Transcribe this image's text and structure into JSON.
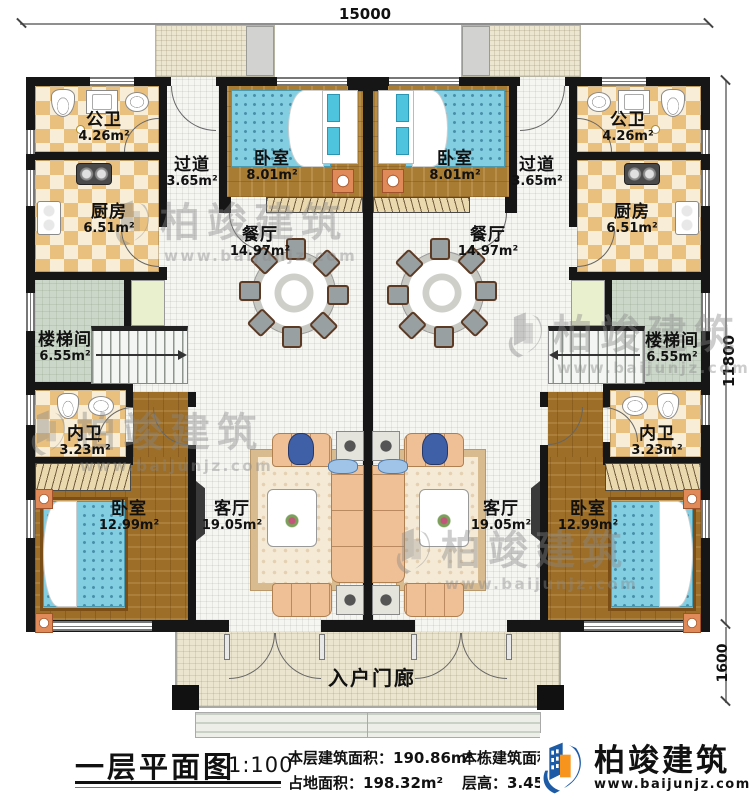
{
  "dimensions": {
    "top": "15000",
    "right_upper": "11800",
    "right_lower": "1600"
  },
  "watermark": {
    "brand": "柏竣建筑",
    "url": "www.baijunjz.com"
  },
  "units": {
    "left": {
      "rooms": [
        {
          "name": "公卫",
          "area": "4.26m²"
        },
        {
          "name": "厨房",
          "area": "6.51m²"
        },
        {
          "name": "过道",
          "area": "3.65m²"
        },
        {
          "name": "卧室",
          "area": "8.01m²"
        },
        {
          "name": "餐厅",
          "area": "14.97m²"
        },
        {
          "name": "楼梯间",
          "area": "6.55m²"
        },
        {
          "name": "内卫",
          "area": "3.23m²"
        },
        {
          "name": "卧室",
          "area": "12.99m²"
        },
        {
          "name": "客厅",
          "area": "19.05m²"
        }
      ]
    },
    "right": {
      "rooms": [
        {
          "name": "公卫",
          "area": "4.26m²"
        },
        {
          "name": "厨房",
          "area": "6.51m²"
        },
        {
          "name": "过道",
          "area": "3.65m²"
        },
        {
          "name": "卧室",
          "area": "8.01m²"
        },
        {
          "name": "餐厅",
          "area": "14.97m²"
        },
        {
          "name": "楼梯间",
          "area": "6.55m²"
        },
        {
          "name": "内卫",
          "area": "3.23m²"
        },
        {
          "name": "卧室",
          "area": "12.99m²"
        },
        {
          "name": "客厅",
          "area": "19.05m²"
        }
      ]
    }
  },
  "porch": {
    "name": "入户门廊"
  },
  "footer": {
    "title": "一层平面图",
    "scale": "1:100",
    "stats": [
      {
        "label": "本层建筑面积：",
        "value": "190.86m²"
      },
      {
        "label": "占地面积：",
        "value": "198.32m²"
      },
      {
        "label": "本栋建筑面积：",
        "value": ""
      },
      {
        "label": "层高：",
        "value": "3.45m"
      }
    ],
    "brand": {
      "name": "柏竣建筑",
      "url": "www.baijunjz.com"
    }
  },
  "colors": {
    "brand_blue": "#1d5ba6",
    "brand_orange": "#f7941d",
    "wall": "#161616"
  }
}
